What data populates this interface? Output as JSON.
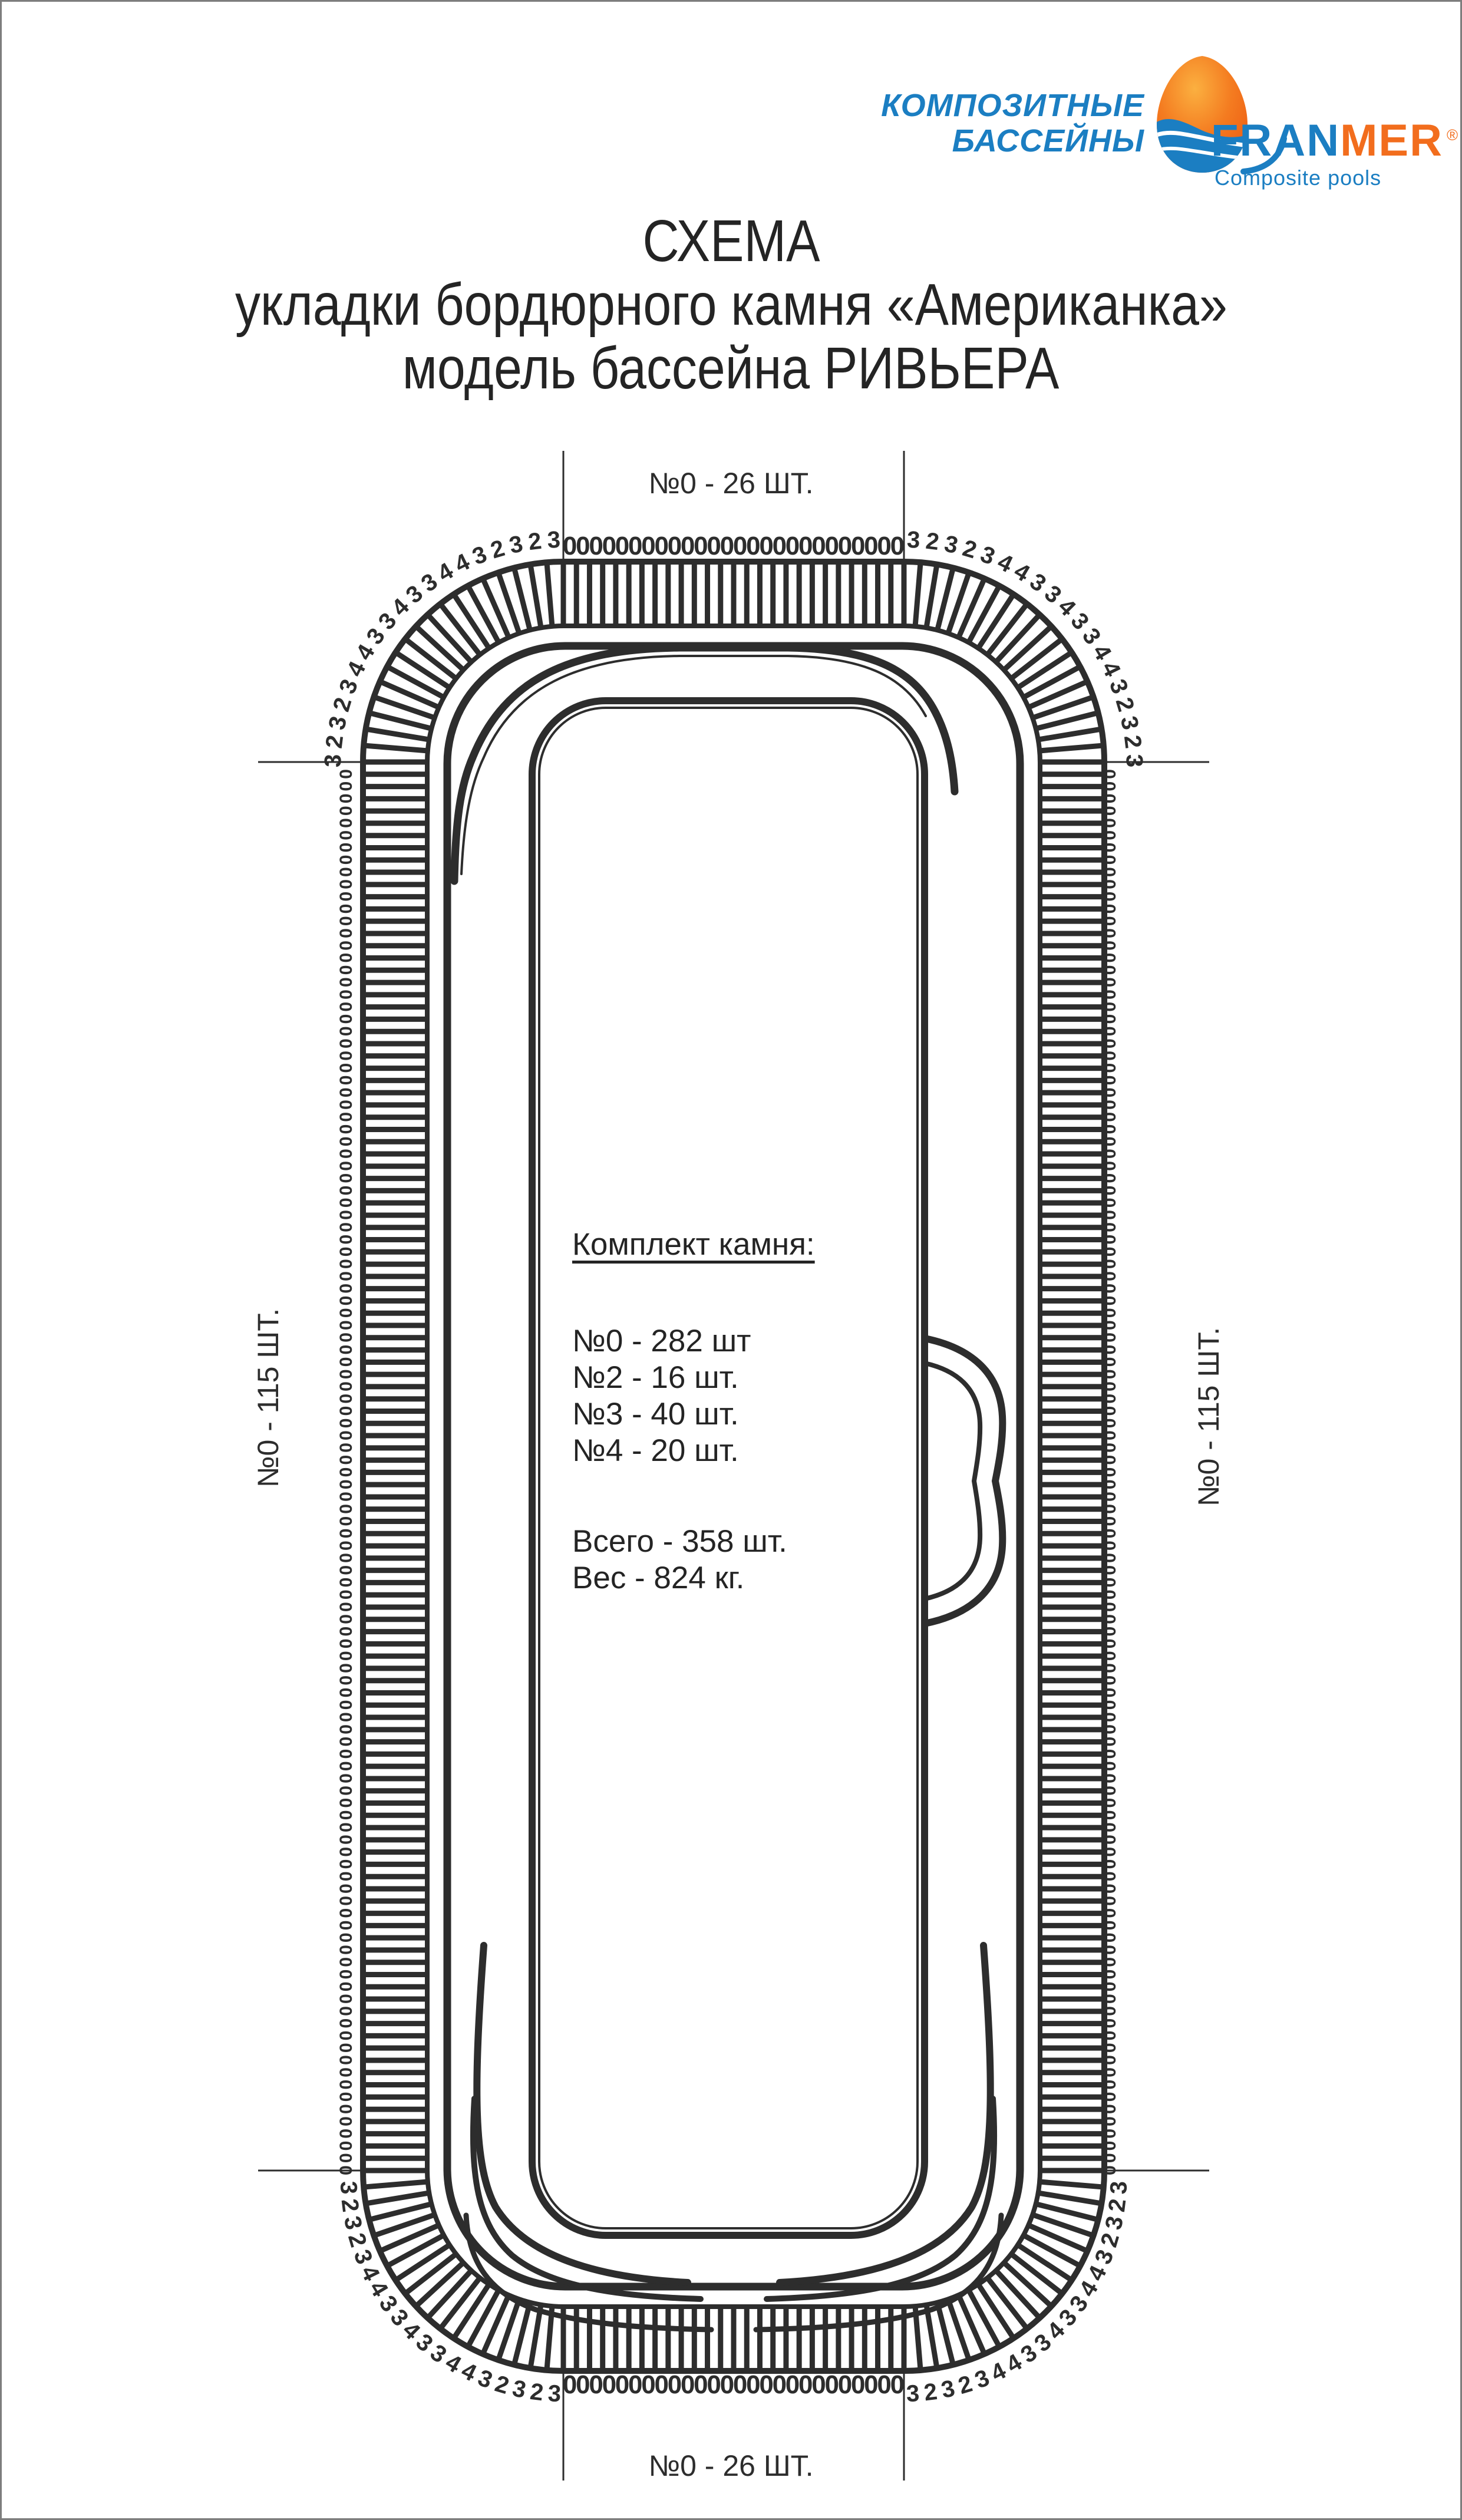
{
  "logo": {
    "line1": "КОМПОЗИТНЫЕ",
    "line2": "БАССЕЙНЫ",
    "brand_part1": "FRAN",
    "brand_part2": "MER",
    "registered_mark": "®",
    "subtitle": "Composite pools",
    "blue": "#1b7ec2",
    "orange": "#f26d1d"
  },
  "title": {
    "line1": "СХЕМА",
    "line2": "укладки бордюрного камня «Американка»",
    "line3": "модель бассейна РИВЬЕРА"
  },
  "legend": {
    "heading": "Комплект камня:",
    "items": [
      "№0 - 282 шт",
      "№2 - 16 шт.",
      "№3 - 40 шт.",
      "№4 - 20 шт."
    ],
    "total": "Всего - 358 шт.",
    "weight": "Вес - 824 кг."
  },
  "diagram": {
    "top_label": "№0 - 26 ШТ.",
    "bottom_label": "№0 - 26 ШТ.",
    "left_label": "№0 - 115 ШТ.",
    "right_label": "№0 - 115 ШТ.",
    "top_count": 26,
    "bottom_count": 26,
    "left_count": 115,
    "right_count": 115,
    "straight_digit": "0",
    "corner_sequence": [
      "3",
      "2",
      "3",
      "2",
      "3",
      "4",
      "4",
      "3",
      "3",
      "4",
      "3",
      "3",
      "4",
      "4",
      "3",
      "2",
      "3",
      "2",
      "3"
    ],
    "stroke_color": "#2d2d2d"
  }
}
